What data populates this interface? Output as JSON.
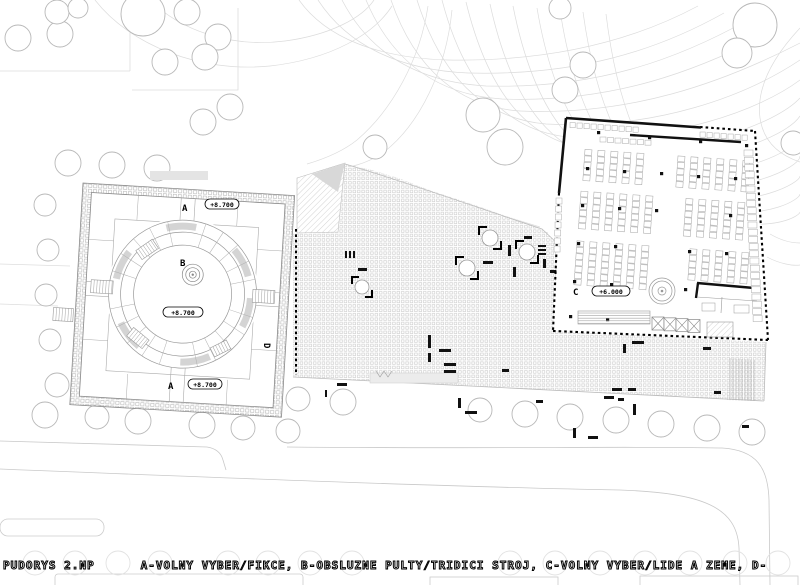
{
  "legend": {
    "line1": "PUDORYS 2.NP      A-VOLNY VYBER/FIKCE, B-OBSLUZNE PULTY/TRIDICI STROJ, C-VOLNY VYBER/LIDE A ZEME, D-",
    "line2": "PERSONAL/OBSLUHA, E- POCHOZI TERASA"
  },
  "plan": {
    "title": "PUDORYS 2.NP",
    "zones": [
      {
        "id": "A",
        "desc": "VOLNY VYBER/FIKCE"
      },
      {
        "id": "B",
        "desc": "OBSLUZNE PULTY/TRIDICI STROJ"
      },
      {
        "id": "C",
        "desc": "VOLNY VYBER/LIDE A ZEME"
      },
      {
        "id": "D",
        "desc": "PERSONAL/OBSLUHA"
      },
      {
        "id": "E",
        "desc": "POCHOZI TERASA"
      }
    ],
    "labels": {
      "blockA_top": "A",
      "blockA_bottom": "A",
      "blockB": "B",
      "blockC": "C",
      "blockD": "D",
      "elev_top": "+8.700",
      "elev_mid": "+8.700",
      "elev_bottom": "+8.700",
      "elev_c": "+6.000"
    }
  },
  "colors": {
    "paper": "#ffffff",
    "contour": "#dcdcdc",
    "wall": "#111111",
    "lightline": "#bbbbbb"
  }
}
